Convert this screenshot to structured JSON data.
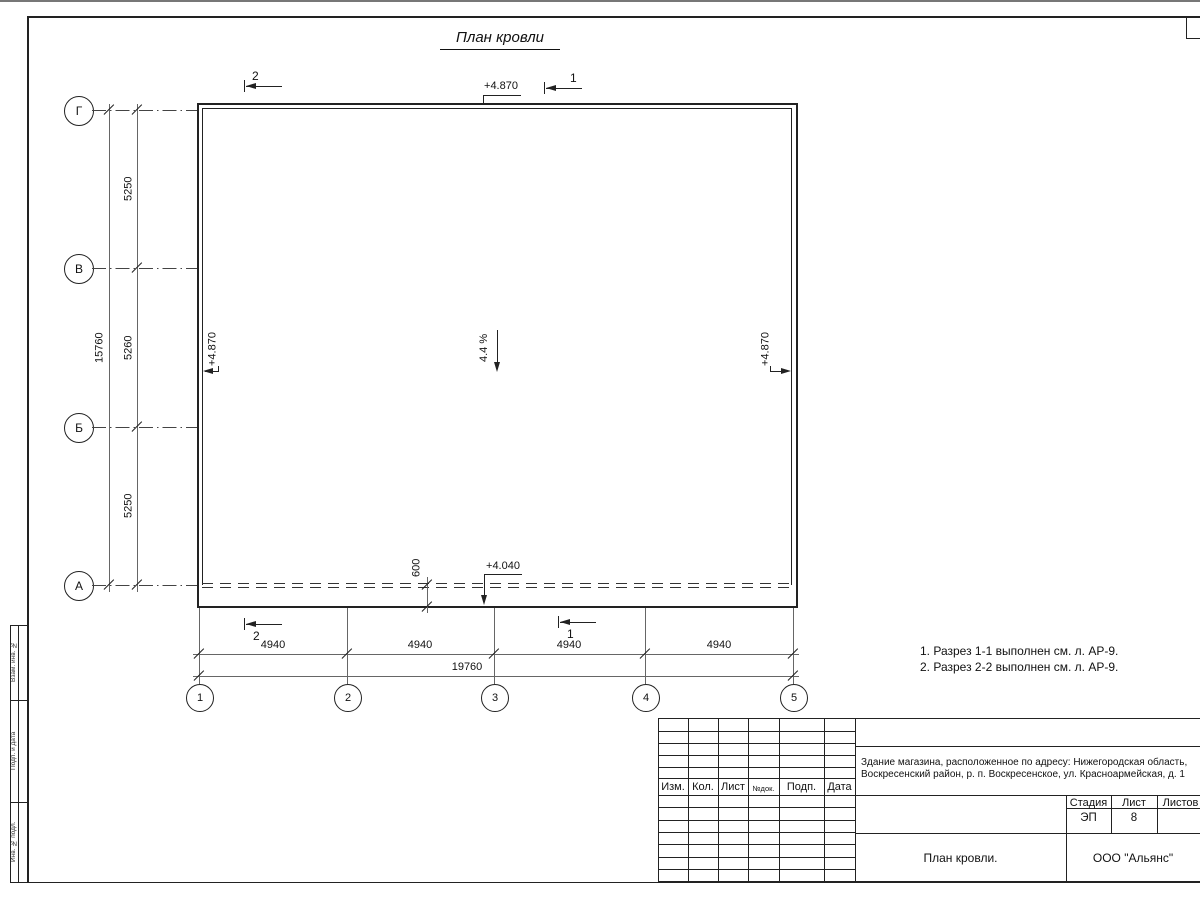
{
  "drawing": {
    "title": "План кровли",
    "slope": "4.4 %",
    "elev_top": "+4.870",
    "elev_left": "+4.870",
    "elev_right": "+4.870",
    "elev_eave": "+4.040",
    "overhang": "600",
    "row_axes": [
      "Г",
      "В",
      "Б",
      "А"
    ],
    "col_axes": [
      "1",
      "2",
      "3",
      "4",
      "5"
    ],
    "v_dims": [
      "5250",
      "5260",
      "5250"
    ],
    "v_total": "15760",
    "h_dims": [
      "4940",
      "4940",
      "4940",
      "4940"
    ],
    "h_total": "19760",
    "sections": {
      "top_left": "2",
      "top_right": "1",
      "bottom_left": "2",
      "bottom_right": "1"
    },
    "notes": [
      "1. Разрез 1-1 выполнен см. л. АР-9.",
      "2. Разрез 2-2 выполнен см. л. АР-9."
    ]
  },
  "title_block": {
    "cols": [
      "Изм.",
      "Кол.",
      "Лист",
      "№док.",
      "Подп.",
      "Дата"
    ],
    "project_line1": "Здание магазина, расположенное по адресу: Нижегородская область,",
    "project_line2": "Воскресенский район, р. п. Воскресенское, ул. Красноармейская, д. 1",
    "stage_label": "Стадия",
    "sheet_label": "Лист",
    "sheets_label": "Листов",
    "stage": "ЭП",
    "sheet_no": "8",
    "drawing_name": "План кровли.",
    "organization": "ООО \"Альянс\""
  },
  "side_strip": {
    "labels": [
      "Взам. инв. №",
      "Подп. и дата",
      "Инв. № подл."
    ]
  }
}
